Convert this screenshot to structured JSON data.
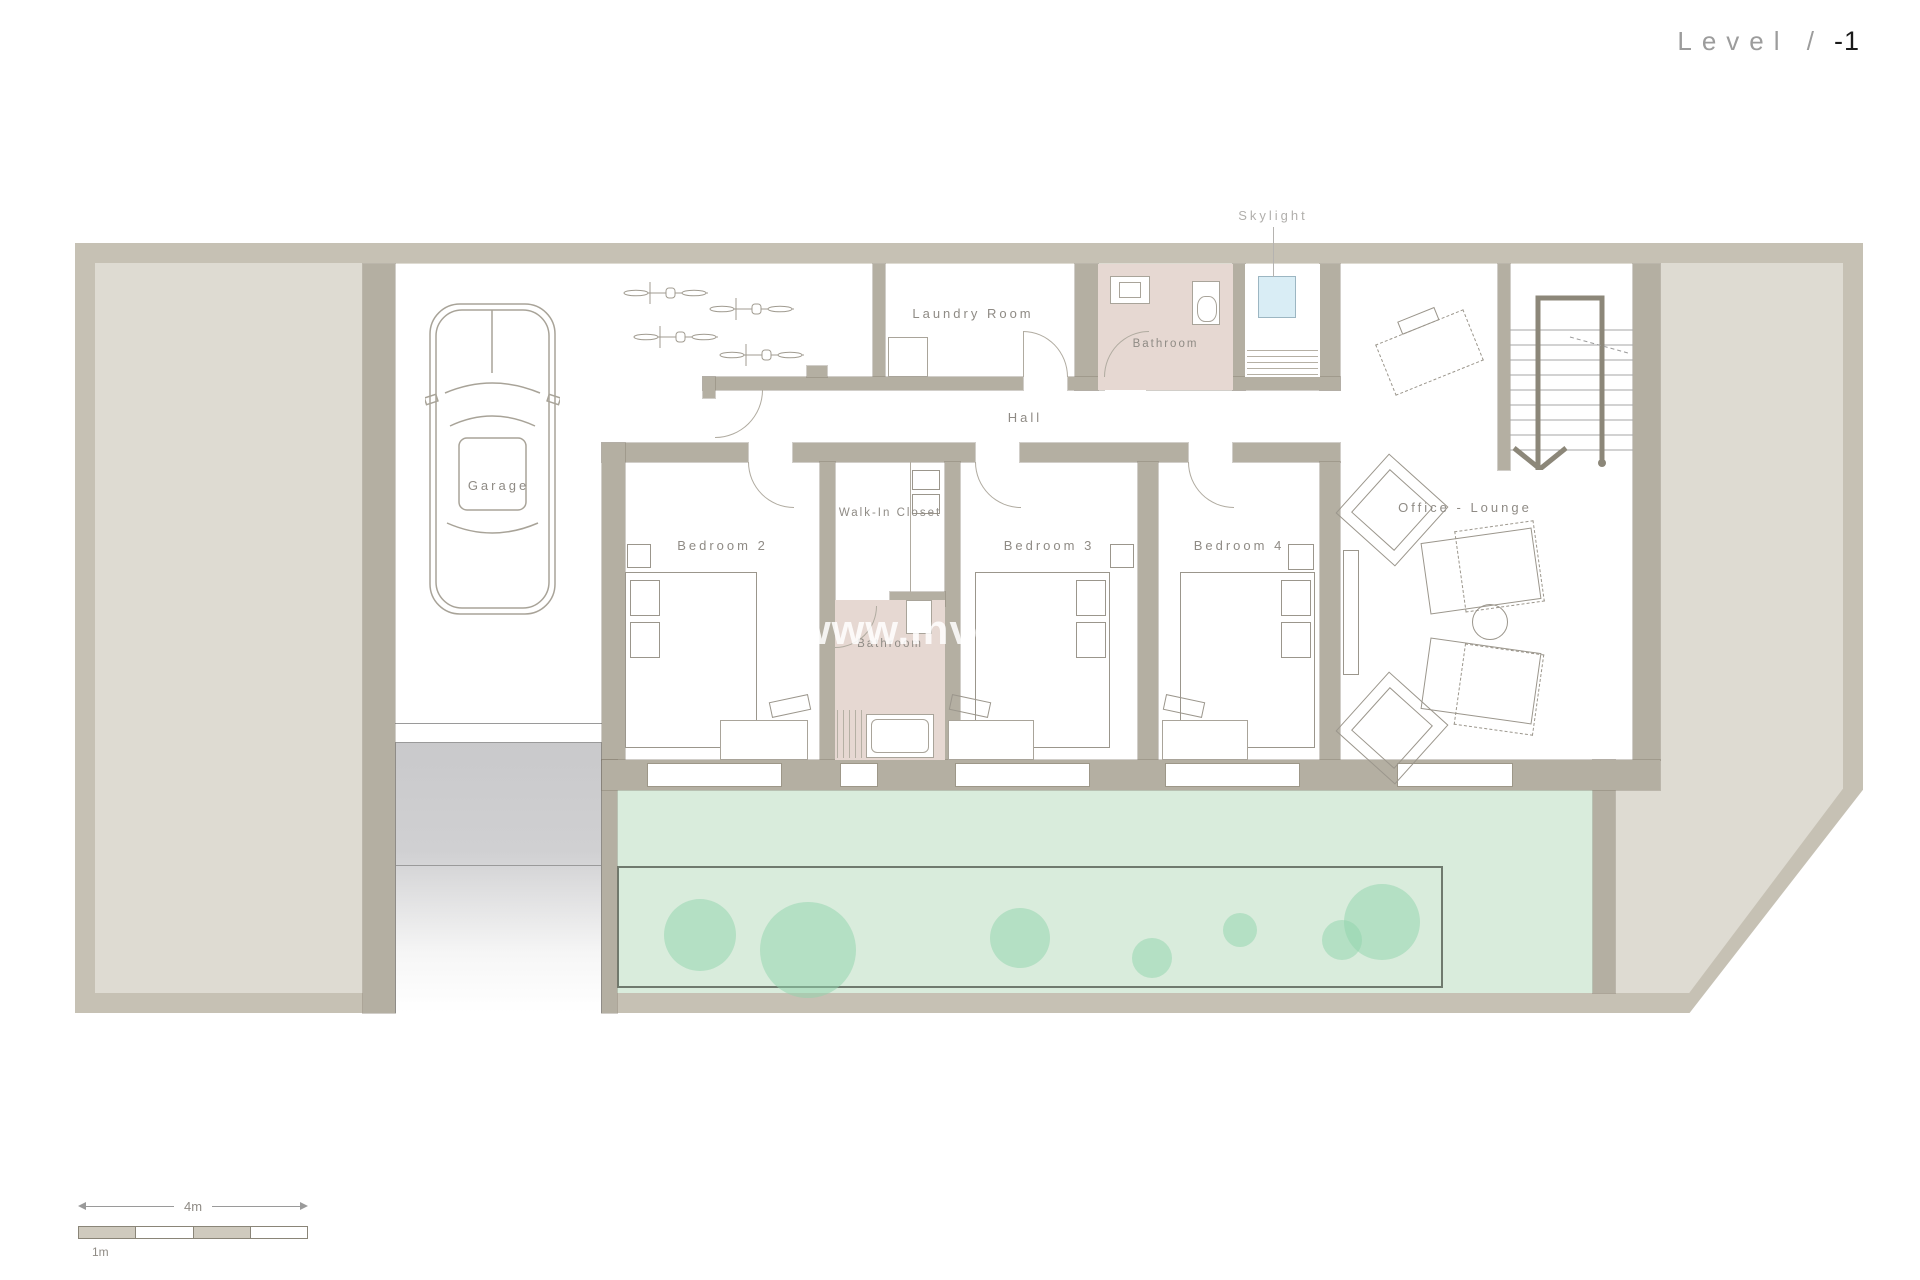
{
  "title": {
    "prefix": "Level /",
    "number": "-1"
  },
  "annotations": {
    "skylight": "Skylight",
    "watermark": "www.invest"
  },
  "rooms": {
    "garage": "Garage",
    "laundry": "Laundry Room",
    "bathroom_top": "Bathroom",
    "hall": "Hall",
    "bedroom2": "Bedroom 2",
    "walkin_closet": "Walk-In Closet",
    "bathroom_small": "Bathroom",
    "bedroom3": "Bedroom 3",
    "bedroom4": "Bedroom 4",
    "office": "Office - Lounge"
  },
  "scale_bar": {
    "total_label": "4m",
    "unit_label": "1m"
  },
  "colors": {
    "outer_wall": "#c6c1b4",
    "inner_wall": "#b4afa2",
    "terrace": "#dedbd2",
    "garden": "#d9ecdc",
    "plant": "#90d3ab",
    "bathroom_floor": "#e6d8d2",
    "skylight_glass": "#d9edf5",
    "ramp": "#c9c9cb",
    "label_text": "#8f8b85"
  }
}
